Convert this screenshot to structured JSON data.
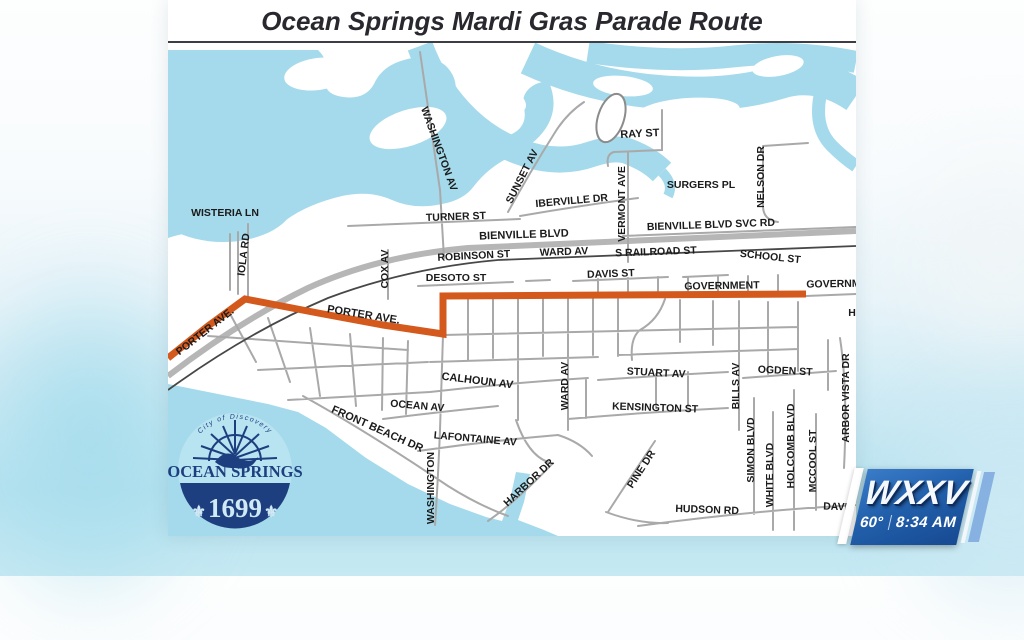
{
  "title": "Ocean Springs Mardi Gras Parade Route",
  "station_badge": {
    "call_letters": "WXXV",
    "temperature": "60°",
    "time": "8:34 AM"
  },
  "seal": {
    "arc_text": "City of Discovery",
    "city": "OCEAN SPRINGS",
    "state": "MISSISSIPPI",
    "year": "1699",
    "fleur": "⚜"
  },
  "map": {
    "route_color": "#d4591c",
    "water_color": "#a4daeb",
    "street_color": "#a9a9a9",
    "highway_color": "#b6b6b6",
    "railroad_color": "#474747",
    "route_points": "0,358 40,326 77,299 150,313 215,325 275,334 275,296 445,295 638,294",
    "street_labels": [
      {
        "t": "WISTERIA LN",
        "x": 57,
        "y": 216,
        "r": 0
      },
      {
        "t": "TURNER ST",
        "x": 288,
        "y": 220,
        "r": -2
      },
      {
        "t": "BIENVILLE BLVD",
        "x": 356,
        "y": 238,
        "r": -2,
        "s": 11
      },
      {
        "t": "IBERVILLE DR",
        "x": 404,
        "y": 204,
        "r": -5
      },
      {
        "t": "RAY ST",
        "x": 472,
        "y": 137,
        "r": -3,
        "s": 11
      },
      {
        "t": "SURGERS PL",
        "x": 533,
        "y": 188,
        "r": 0
      },
      {
        "t": "BIENVILLE BLVD SVC RD",
        "x": 543,
        "y": 228,
        "r": -2
      },
      {
        "t": "WARD AV",
        "x": 396,
        "y": 255,
        "r": -2
      },
      {
        "t": "S RAILROAD ST",
        "x": 488,
        "y": 255,
        "r": -2
      },
      {
        "t": "SCHOOL ST",
        "x": 602,
        "y": 260,
        "r": 6
      },
      {
        "t": "ROBINSON ST",
        "x": 306,
        "y": 259,
        "r": -3
      },
      {
        "t": "DESOTO ST",
        "x": 288,
        "y": 281,
        "r": 0
      },
      {
        "t": "DAVIS ST",
        "x": 443,
        "y": 277,
        "r": -2
      },
      {
        "t": "GOVERNMENT",
        "x": 554,
        "y": 289,
        "r": -1
      },
      {
        "t": "GOVERNMENT",
        "x": 676,
        "y": 287,
        "r": -1
      },
      {
        "t": "H",
        "x": 684,
        "y": 316,
        "r": 0
      },
      {
        "t": "PORTER AVE.",
        "x": 195,
        "y": 318,
        "r": 9,
        "s": 11
      },
      {
        "t": "PORTER AVE.",
        "x": 39,
        "y": 334,
        "r": -38
      },
      {
        "t": "CALHOUN AV",
        "x": 309,
        "y": 384,
        "r": 7,
        "s": 11
      },
      {
        "t": "OCEAN AV",
        "x": 249,
        "y": 409,
        "r": 5
      },
      {
        "t": "LAFONTAINE AV",
        "x": 307,
        "y": 442,
        "r": 5
      },
      {
        "t": "FRONT BEACH DR",
        "x": 208,
        "y": 432,
        "r": 24,
        "s": 11
      },
      {
        "t": "STUART AV",
        "x": 488,
        "y": 376,
        "r": 3
      },
      {
        "t": "KENSINGTON ST",
        "x": 487,
        "y": 411,
        "r": 2
      },
      {
        "t": "OGDEN ST",
        "x": 617,
        "y": 374,
        "r": 3
      },
      {
        "t": "HUDSON RD",
        "x": 539,
        "y": 513,
        "r": 2
      },
      {
        "t": "DAVID",
        "x": 671,
        "y": 510,
        "r": 2
      },
      {
        "t": "HARBOR DR",
        "x": 363,
        "y": 485,
        "r": -43
      },
      {
        "t": "PINE DR",
        "x": 476,
        "y": 471,
        "r": -57
      },
      {
        "t": "WASHINGTON AV",
        "x": 268,
        "y": 150,
        "r": 70
      },
      {
        "t": "SUNSET AV",
        "x": 357,
        "y": 178,
        "r": -63
      },
      {
        "t": "VERMONT AVE",
        "x": 457,
        "y": 204,
        "r": -90
      },
      {
        "t": "NELSON DR",
        "x": 596,
        "y": 177,
        "r": -90
      },
      {
        "t": "IOLA RD",
        "x": 79,
        "y": 255,
        "r": -83
      },
      {
        "t": "COX AV",
        "x": 220,
        "y": 269,
        "r": -90
      },
      {
        "t": "WARD AV",
        "x": 400,
        "y": 386,
        "r": -90
      },
      {
        "t": "BILLS AV",
        "x": 571,
        "y": 386,
        "r": -90
      },
      {
        "t": "SIMON BLVD",
        "x": 586,
        "y": 450,
        "r": -90
      },
      {
        "t": "WHITE BLVD",
        "x": 605,
        "y": 475,
        "r": -90
      },
      {
        "t": "HOLCOMB BLVD",
        "x": 626,
        "y": 446,
        "r": -90
      },
      {
        "t": "MCCOOL ST",
        "x": 648,
        "y": 461,
        "r": -90
      },
      {
        "t": "ARBOR VISTA DR",
        "x": 681,
        "y": 398,
        "r": -90
      },
      {
        "t": "WASHINGTON",
        "x": 266,
        "y": 488,
        "r": -90
      }
    ]
  }
}
